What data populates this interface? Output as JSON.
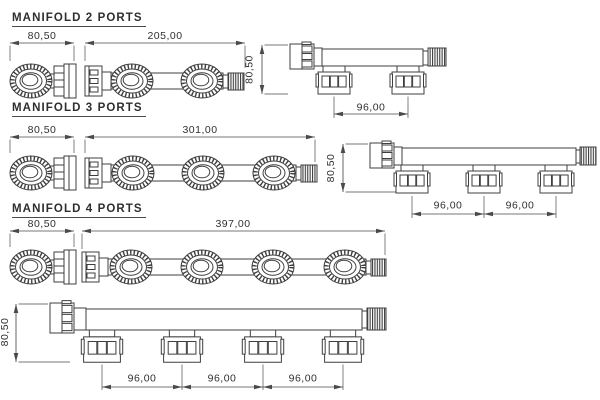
{
  "drawing": {
    "kind": "manifold technical drawing",
    "colors": {
      "background": "#ffffff",
      "line": "#3f3f3f",
      "dimension_line": "#4a4a4a",
      "text": "#2e2e2e"
    }
  },
  "sections": [
    {
      "title": "MANIFOLD 2 PORTS",
      "dimensions": {
        "end_width": "80,50",
        "length": "205,00",
        "height": "80,50",
        "port_spacing": [
          "96,00"
        ]
      }
    },
    {
      "title": "MANIFOLD 3 PORTS",
      "dimensions": {
        "end_width": "80,50",
        "length": "301,00",
        "height": "80,50",
        "port_spacing": [
          "96,00",
          "96,00"
        ]
      }
    },
    {
      "title": "MANIFOLD 4 PORTS",
      "dimensions": {
        "end_width": "80,50",
        "length": "397,00",
        "height": "80,50",
        "port_spacing": [
          "96,00",
          "96,00",
          "96,00"
        ]
      }
    }
  ]
}
